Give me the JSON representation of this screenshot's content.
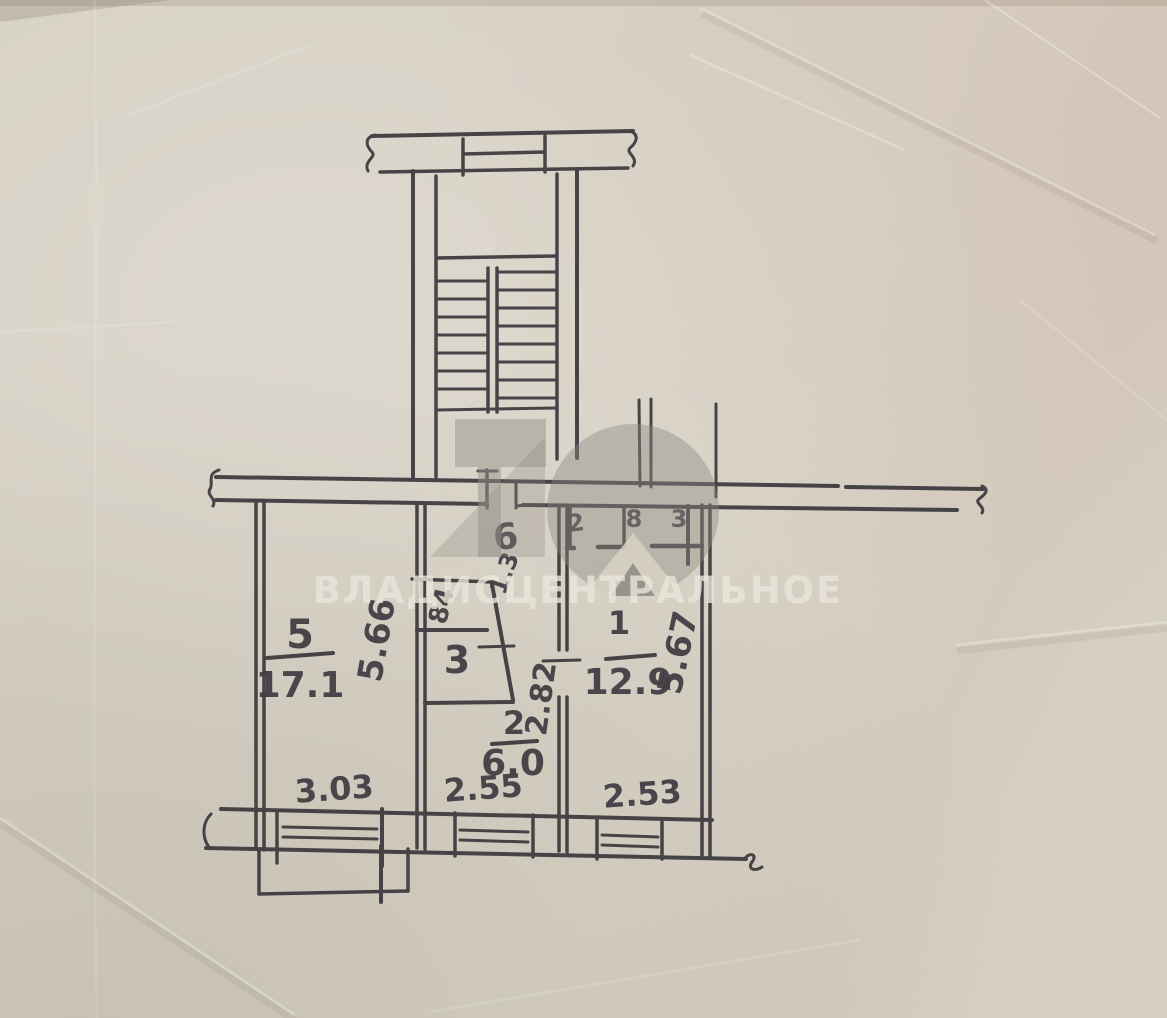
{
  "paper": {
    "color": "#d7d1c5"
  },
  "ink": {
    "color": "#3a383c"
  },
  "watermark": {
    "text": "ВЛАДИСЦЕНТРАЛЬНОЕ",
    "text_color": "#ebe7dc",
    "logo_color": "#8d8a82"
  },
  "rooms": [
    {
      "number": "5",
      "area": "17.1"
    },
    {
      "number": "1",
      "area": "12.9"
    },
    {
      "number": "2",
      "area": "6.0"
    },
    {
      "number": "3",
      "area": ""
    },
    {
      "number": "6",
      "area": ""
    }
  ],
  "labels": {
    "room5_number": "5",
    "room5_area": "17.1",
    "room5_depth": "5.66",
    "room1_number": "1",
    "room1_area": "12.9",
    "room1_depth": "5.67",
    "room2_number": "2",
    "room2_area": "6.0",
    "room2_height": "2.82",
    "room3_number": "3",
    "room6_number": "6",
    "window_room5": "3.03",
    "window_kitchen": "2.55",
    "window_room1": "2.53",
    "dim_closet": "84",
    "dim_hall": "1.3",
    "mark_a": "2",
    "mark_b": "8",
    "mark_c": "3"
  }
}
